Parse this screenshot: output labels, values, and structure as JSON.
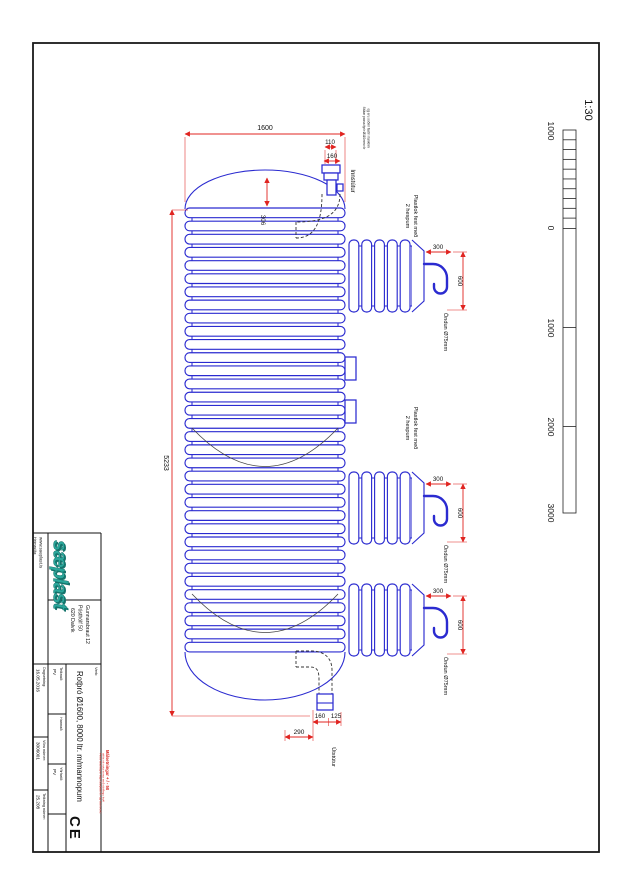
{
  "sheet": {
    "colors": {
      "line_blue": "#2B2BD0",
      "dim_red": "#E02420",
      "logo_teal": "#2AA79B"
    },
    "scale": {
      "label": "1:30",
      "ticks": [
        "1000",
        "0",
        "1000",
        "2000",
        "3000"
      ]
    },
    "dimensions": {
      "total_length": "5233",
      "diameter": "1600",
      "dome_height": "306",
      "inlet_width": "110",
      "inlet_outer": "160",
      "vent_offset": "300",
      "vent_height": "600",
      "outlet_a": "160",
      "outlet_b": "125",
      "outlet_c": "290"
    },
    "labels": {
      "inlet": "Innstútur",
      "outlet": "Útstútur",
      "vent": "Öndun Ø75mm",
      "lid_note_line1": "Plastlok fest með",
      "lid_note_line2": "2 hespum",
      "inlet_note_line1": "Stútar passa fyrir Ø110mm rör",
      "inlet_note_line2": "og eru soðnir fastir í tankinn"
    },
    "title_block": {
      "homepage_label": "Heimasíða:",
      "homepage_url": "www.saeplast.is",
      "logo": "sæplast",
      "address_line1": "Gunnarsbraut 12",
      "address_line2": "Pósthólf 50",
      "address_line3": "620 Dalvík",
      "project_label": "Verk:",
      "project_title": "Rotþró Ø1600, 8000 ltr. m/mannopum",
      "drawn_label": "Teiknað:",
      "drawn_value": "PV",
      "date_label": "Dagsetning:",
      "date_value": "16.05.2016",
      "designed_label": "Hannað:",
      "designed_value": "",
      "product_no_label": "Vöru númer:",
      "product_no_value": "3006001",
      "checked_label": "Yfirfarið:",
      "checked_value": "PV",
      "drawing_no_label": "Teikning númer:",
      "drawing_no_value": "25.208",
      "tolerance_note": "Málsetningar + / - 50",
      "fine_print_line1": "Þessi teikning er eign Sæplast hf. og má hvorki",
      "fine_print_line2": "afrita né nota nema með skriflegu leyfi",
      "ce_mark": "CE"
    }
  }
}
